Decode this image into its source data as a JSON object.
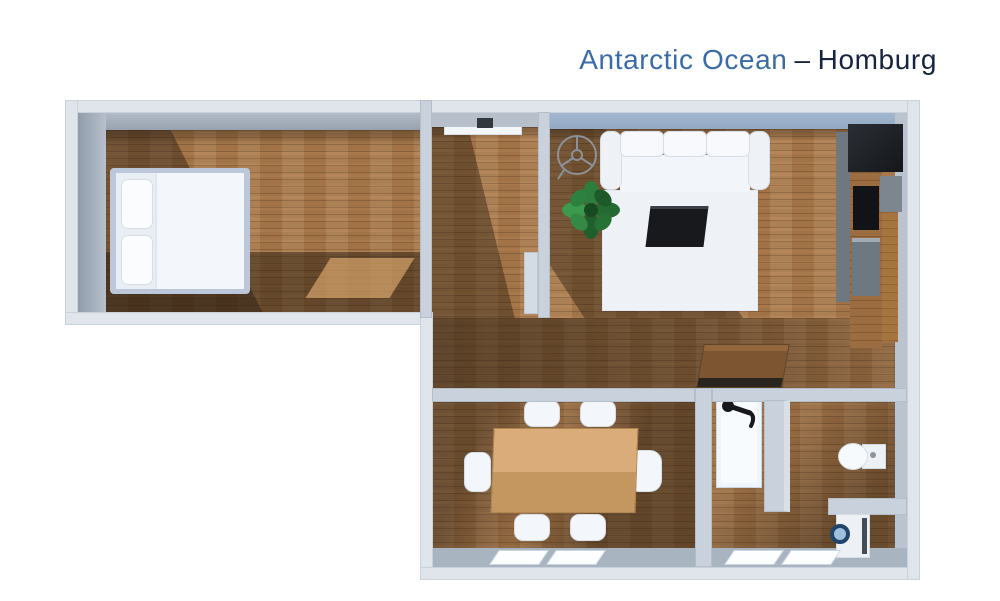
{
  "title": {
    "property_name": "Antarctic Ocean",
    "separator": "–",
    "location": "Homburg",
    "property_color": "#3a6ba9",
    "location_color": "#17243f"
  },
  "floor_plan": {
    "view": "3d-top-down",
    "outer_wall_color": "#e0e5ec",
    "inner_wall_color": "#c9d2dc",
    "floor_wood_color": "#a8794c",
    "rooms": [
      {
        "name": "bedroom",
        "furniture": [
          "double-bed",
          "pillows",
          "area-rug"
        ]
      },
      {
        "name": "entry-hall",
        "furniture": [
          "wall-console"
        ]
      },
      {
        "name": "living-room",
        "furniture": [
          "ceiling-fan",
          "potted-plant",
          "sofa",
          "white-rug",
          "coffee-table"
        ]
      },
      {
        "name": "kitchen",
        "furniture": [
          "refrigerator",
          "cooktop",
          "oven",
          "counter",
          "cabinet"
        ]
      },
      {
        "name": "hallway",
        "furniture": [
          "desk"
        ]
      },
      {
        "name": "dining-room",
        "furniture": [
          "dining-table",
          "chair",
          "chair",
          "chair",
          "chair",
          "chair",
          "chair"
        ]
      },
      {
        "name": "bathroom",
        "furniture": [
          "shower",
          "shower-fixture",
          "toilet",
          "washing-machine"
        ]
      }
    ]
  }
}
